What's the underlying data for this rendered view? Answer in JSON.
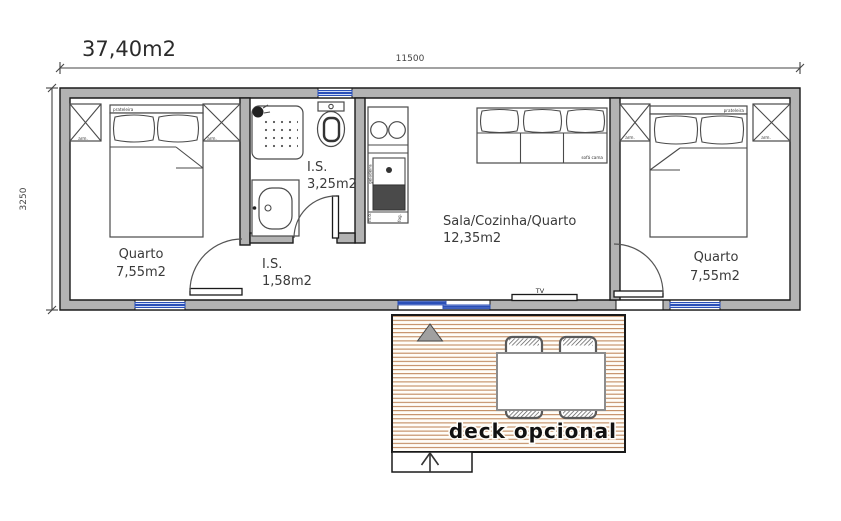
{
  "title": "37,40m2",
  "dimensions": {
    "width": "11500",
    "height": "3250"
  },
  "rooms": {
    "bedroom_left": {
      "name": "Quarto",
      "area": "7,55m2"
    },
    "bathroom": {
      "name": "I.S.",
      "area": "3,25m2"
    },
    "hall_wc": {
      "name": "I.S.",
      "area": "1,58m2"
    },
    "living_kitchen": {
      "name": "Sala/Cozinha/Quarto",
      "area": "12,35m2"
    },
    "bedroom_right": {
      "name": "Quarto",
      "area": "7,55m2"
    }
  },
  "labels": {
    "shelf": "prateleira",
    "wardrobe": "arm.",
    "sofa_bed": "sofá cama",
    "tv": "TV",
    "fridge": "geladeira",
    "micro": "m.o.",
    "stove": "fog.",
    "deck": "deck opcional"
  },
  "theme": {
    "wall": "#b3b3b3",
    "line": "#1a1a1a",
    "window_blue": "#2a4fb8",
    "window_light": "#e8effc",
    "deck_plank": "#bb7f52",
    "text": "#3a3a3a"
  }
}
